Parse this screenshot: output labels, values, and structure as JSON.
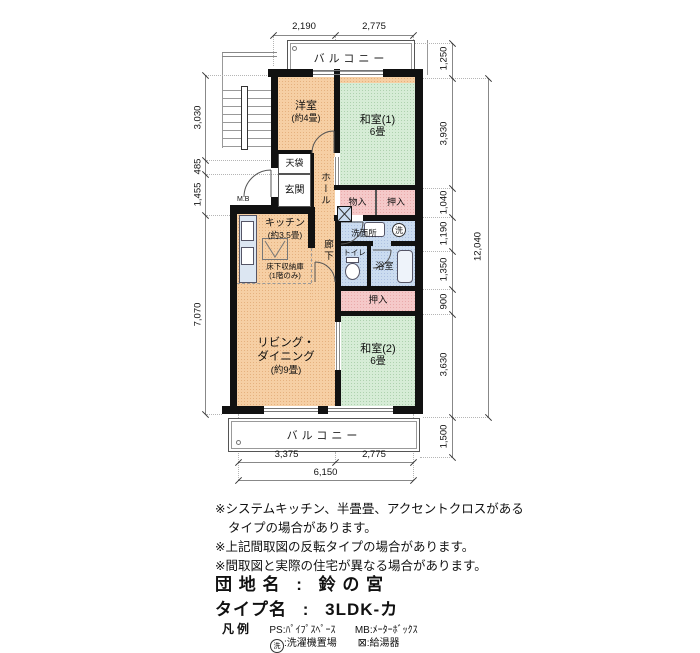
{
  "plan": {
    "balcony_top": "バルコニー",
    "balcony_bottom": "バルコニー",
    "rooms": {
      "yoshitsu": {
        "name": "洋室",
        "size": "(約4畳)"
      },
      "washitsu1": {
        "name": "和室(1)",
        "size": "6畳"
      },
      "washitsu2": {
        "name": "和室(2)",
        "size": "6畳"
      },
      "living": {
        "line1": "リビング・",
        "line2": "ダイニング",
        "size": "(約9畳)"
      },
      "kitchen": {
        "name": "キッチン",
        "size": "(約3.5畳)"
      },
      "yukashita": {
        "line1": "床下収納庫",
        "line2": "(1階のみ)"
      },
      "genkan": "玄関",
      "hall": "ホール",
      "rouka": "廊下",
      "tenbukuro": "天袋",
      "monoire": "物入",
      "oshiire_upper": "押入",
      "oshiire_lower": "押入",
      "senmenjo": "洗面所",
      "toilet": "トイレ",
      "bath": "浴室",
      "mb": "M.B",
      "washer_mark": "洗"
    },
    "dims": {
      "top": [
        "2,190",
        "2,775"
      ],
      "left": [
        "3,030",
        "485",
        "1,455",
        "7,070"
      ],
      "right": [
        "1,250",
        "3,930",
        "1,040",
        "1,190",
        "1,350",
        "900",
        "3,630",
        "1,500"
      ],
      "right_total": "12,040",
      "bottom": [
        "3,375",
        "2,775"
      ],
      "bottom_total": "6,150"
    }
  },
  "notes": {
    "n1": "※システムキッチン、半畳畳、アクセントクロスがある",
    "n1b": "タイプの場合があります。",
    "n2": "※上記間取図の反転タイプの場合があります。",
    "n3": "※間取図と実際の住宅が異なる場合があります。"
  },
  "info": {
    "danchi_label": "団 地 名",
    "separator": ":",
    "danchi_value": "鈴 の 宮",
    "type_label": "タイプ名",
    "type_value": "3LDK-カ"
  },
  "legend": {
    "title": "凡例",
    "ps": "PS:ﾊﾟｲﾌﾟｽﾍﾟｰｽ",
    "mb": "MB:ﾒｰﾀｰﾎﾞｯｸｽ",
    "washer_mark": "洗",
    "washer_text": ":洗濯機置場",
    "heater_symbol": "⊠",
    "heater_text": ":給湯器"
  },
  "colors": {
    "room_peach": "#f6cfa4",
    "tatami_green": "#d6ecd6",
    "closet_pink": "#f5c9c9",
    "wet_blue": "#cbdcf0",
    "wall": "#111111"
  }
}
